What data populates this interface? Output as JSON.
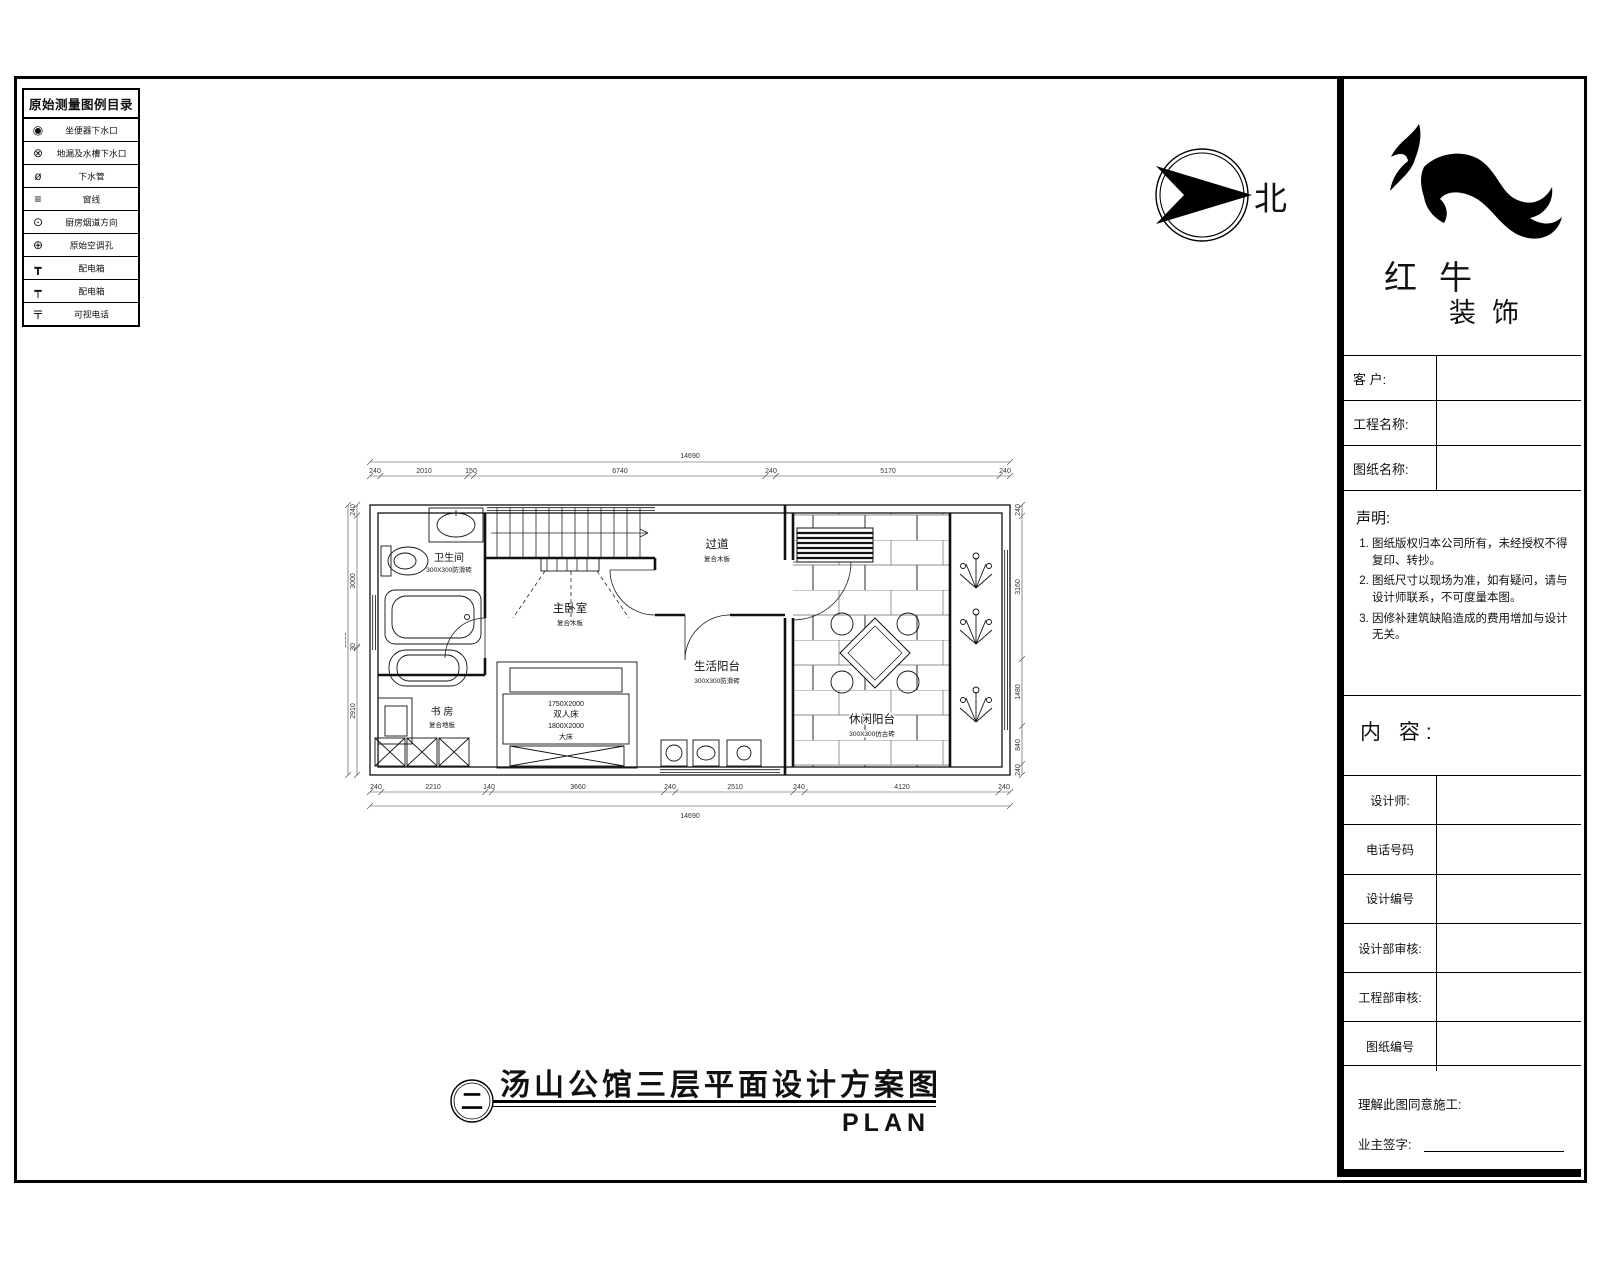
{
  "legend": {
    "title": "原始测量图例目录",
    "items": [
      {
        "icon": "toilet-drain-icon",
        "glyph": "◉",
        "label": "坐便器下水口"
      },
      {
        "icon": "floor-drain-icon",
        "glyph": "⊗",
        "label": "地漏及水槽下水口"
      },
      {
        "icon": "drain-pipe-icon",
        "glyph": "ø",
        "label": "下水管"
      },
      {
        "icon": "window-line-icon",
        "glyph": "≡",
        "label": "窗线"
      },
      {
        "icon": "kitchen-flue-icon",
        "glyph": "⊙",
        "label": "厨房烟道方向"
      },
      {
        "icon": "ac-hole-icon",
        "glyph": "⊕",
        "label": "原始空调孔"
      },
      {
        "icon": "distribution-box-icon",
        "glyph": "┳",
        "label": "配电箱"
      },
      {
        "icon": "distribution-box2-icon",
        "glyph": "┯",
        "label": "配电箱"
      },
      {
        "icon": "video-phone-icon",
        "glyph": "〒",
        "label": "可视电话"
      }
    ]
  },
  "north": {
    "label": "北"
  },
  "logo": {
    "name": "红牛",
    "sub": "装饰"
  },
  "titleblock": {
    "fields": [
      {
        "label": "客  户:"
      },
      {
        "label": "工程名称:"
      },
      {
        "label": "图纸名称:"
      }
    ],
    "statement": {
      "title": "声明:",
      "items": [
        "图纸版权归本公司所有，未经授权不得复印、转抄。",
        "图纸尺寸以现场为准，如有疑问，请与设计师联系，不可度量本图。",
        "因修补建筑缺陷造成的费用增加与设计无关。"
      ]
    },
    "content_label": "内 容:",
    "rows": [
      {
        "label": "设计师:"
      },
      {
        "label": "电话号码"
      },
      {
        "label": "设计编号"
      },
      {
        "label": "设计部审核:"
      },
      {
        "label": "工程部审核:"
      },
      {
        "label": "图纸编号"
      }
    ],
    "footer": {
      "line1": "理解此图同意施工:",
      "line2": "业主签字:"
    }
  },
  "plan": {
    "rooms": {
      "bathroom": {
        "name": "卫生间",
        "finish": "300X300防滑砖"
      },
      "master": {
        "name": "主卧室",
        "finish": "复合木板"
      },
      "corridor": {
        "name": "过道",
        "finish": "复合木板"
      },
      "life_balcony": {
        "name": "生活阳台",
        "finish": "300X300防滑砖"
      },
      "study": {
        "name": "书 房",
        "finish": "复合地板"
      },
      "leisure_balcony": {
        "name": "休闲阳台",
        "finish": "300X300仿古砖"
      }
    },
    "bed": {
      "l1": "1750X2000",
      "l2": "双人床",
      "l3": "1800X2000",
      "l4": "大床"
    },
    "dims": {
      "top": {
        "total": "14690",
        "segments": [
          "240",
          "2010",
          "150",
          "6740",
          "240",
          "5170",
          "240"
        ]
      },
      "bottom": {
        "total": "14690",
        "segments": [
          "240",
          "2210",
          "140",
          "3660",
          "240",
          "2510",
          "240",
          "4120",
          "240"
        ]
      },
      "left": {
        "total": "5930",
        "segments": [
          "240",
          "3000",
          "30",
          "2910"
        ]
      },
      "right": {
        "segments": [
          "240",
          "3160",
          "1480",
          "840",
          "240"
        ]
      }
    }
  },
  "drawing_title": {
    "symbol": "二",
    "title": "汤山公馆三层平面设计方案图",
    "plan_label": "PLAN"
  }
}
